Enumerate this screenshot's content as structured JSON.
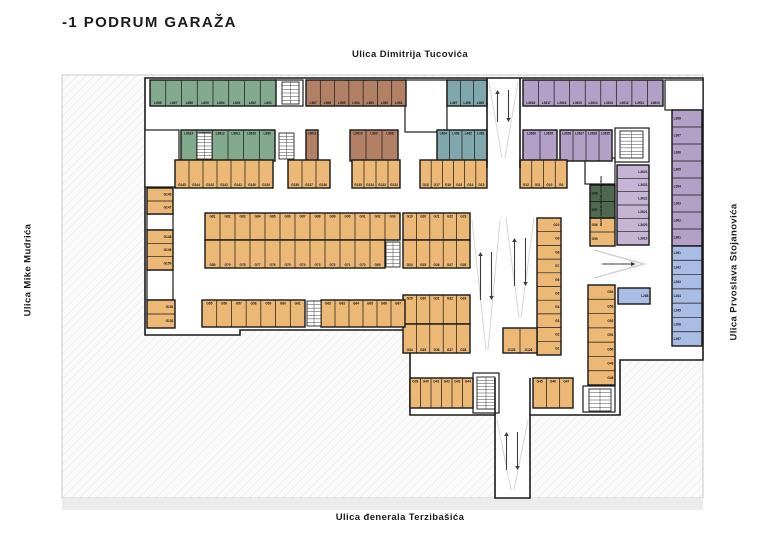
{
  "title": "-1 PODRUM GARAŽA",
  "streets": {
    "top": "Ulica Dimitrija Tucovića",
    "bottom": "Ulica đenerala Terzibašića",
    "left": "Ulica Mike Mudrića",
    "right": "Ulica Prvoslava Stojanovića"
  },
  "plan": {
    "colors": {
      "site": "#fbfbfb",
      "hatch": "#e3e3e3",
      "wall": "#1a1a1a",
      "street_band": "#ececec",
      "slope": "#d6d6d6",
      "arrow": "#3d3d3d",
      "chevron": "#cfcfcf",
      "label": "#141414",
      "green": "#83aa8c",
      "brown": "#b28165",
      "teal": "#7fa7ac",
      "purple": "#b3a0c6",
      "purple_light": "#c6b4d5",
      "blue": "#a9bce4",
      "orange": "#ecb875",
      "darkgreen": "#4e6950"
    },
    "site": {
      "x": 62,
      "y": 75,
      "w": 641,
      "h": 423
    },
    "street_band": {
      "x": 62,
      "y": 498,
      "w": 641,
      "h": 12
    },
    "outline": [
      [
        145,
        78
      ],
      [
        703,
        78
      ],
      [
        703,
        360
      ],
      [
        620,
        360
      ],
      [
        620,
        415
      ],
      [
        530,
        415
      ],
      [
        530,
        498
      ],
      [
        495,
        498
      ],
      [
        495,
        415
      ],
      [
        410,
        415
      ],
      [
        410,
        330
      ],
      [
        240,
        330
      ],
      [
        240,
        335
      ],
      [
        145,
        335
      ]
    ],
    "rooms": [
      [
        275,
        80,
        28,
        26
      ],
      [
        405,
        80,
        42,
        52
      ],
      [
        665,
        80,
        38,
        30
      ],
      [
        145,
        130,
        34,
        57
      ],
      [
        615,
        128,
        34,
        34
      ],
      [
        473,
        373,
        26,
        40
      ],
      [
        583,
        386,
        32,
        26
      ],
      [
        585,
        158,
        30,
        26
      ],
      [
        147,
        214,
        26,
        16
      ],
      [
        147,
        270,
        26,
        30
      ]
    ],
    "walls": [
      [
        487,
        78,
        487,
        168
      ],
      [
        520,
        78,
        520,
        168
      ],
      [
        495,
        378,
        495,
        415
      ],
      [
        530,
        378,
        530,
        415
      ]
    ],
    "slopes": [
      [
        489,
        82,
        502,
        158
      ],
      [
        518,
        82,
        505,
        158
      ],
      [
        472,
        220,
        486,
        350
      ],
      [
        500,
        220,
        488,
        350
      ],
      [
        506,
        218,
        519,
        318
      ],
      [
        534,
        218,
        521,
        318
      ],
      [
        497,
        420,
        511,
        490
      ],
      [
        528,
        420,
        514,
        490
      ]
    ],
    "arrows": [
      {
        "cx": 503,
        "y1": 90,
        "y2": 122
      },
      {
        "cx": 486,
        "y1": 252,
        "y2": 300
      },
      {
        "cx": 520,
        "y1": 238,
        "y2": 286
      },
      {
        "cx": 512,
        "y1": 432,
        "y2": 470
      }
    ],
    "chevron": {
      "x1": 594,
      "y1": 250,
      "xm": 644,
      "ym": 264,
      "x2": 594,
      "y2": 278,
      "ax1": 602,
      "ax2": 632
    },
    "stairs": [
      [
        282,
        82,
        17,
        22
      ],
      [
        197,
        133,
        15,
        26
      ],
      [
        279,
        133,
        15,
        26
      ],
      [
        386,
        242,
        14,
        25
      ],
      [
        307,
        301,
        14,
        25
      ],
      [
        477,
        377,
        18,
        32
      ],
      [
        620,
        131,
        23,
        27
      ],
      [
        589,
        389,
        22,
        22
      ]
    ],
    "ev_text": {
      "x": 602,
      "y": 201,
      "label": "MESTO ZA ELEKTRIČNE AUTOMOBILE"
    },
    "zones": [
      {
        "name": "green",
        "color": "green",
        "groups": [
          {
            "x": 150,
            "y": 80,
            "w": 126,
            "h": 26,
            "dir": "h",
            "pos": "bottom",
            "labels": [
              "L868",
              "L867",
              "L866",
              "L865",
              "L864",
              "L863",
              "L862",
              "L861"
            ]
          },
          {
            "x": 181,
            "y": 130,
            "w": 94,
            "h": 31,
            "dir": "h",
            "pos": "top",
            "labels": [
              "L8614",
              "L8613",
              "L8612",
              "L8611",
              "L8610",
              "L869"
            ]
          }
        ]
      },
      {
        "name": "brown",
        "color": "brown",
        "groups": [
          {
            "x": 306,
            "y": 80,
            "w": 100,
            "h": 26,
            "dir": "h",
            "pos": "bottom",
            "labels": [
              "L567",
              "L566",
              "L565",
              "L564",
              "L563",
              "L562",
              "L561"
            ]
          },
          {
            "x": 306,
            "y": 130,
            "w": 12,
            "h": 31,
            "dir": "h",
            "pos": "top",
            "labels": [
              "L5611"
            ]
          },
          {
            "x": 350,
            "y": 130,
            "w": 48,
            "h": 31,
            "dir": "h",
            "pos": "top",
            "labels": [
              "L5610",
              "L569",
              "L568"
            ]
          }
        ]
      },
      {
        "name": "teal",
        "color": "teal",
        "groups": [
          {
            "x": 447,
            "y": 80,
            "w": 40,
            "h": 26,
            "dir": "h",
            "pos": "bottom",
            "labels": [
              "L467",
              "L466",
              "L465"
            ]
          },
          {
            "x": 437,
            "y": 130,
            "w": 50,
            "h": 31,
            "dir": "h",
            "pos": "top",
            "labels": [
              "L464",
              "L463",
              "L462",
              "L461"
            ]
          }
        ]
      },
      {
        "name": "purple",
        "color": "purple",
        "groups": [
          {
            "x": 523,
            "y": 80,
            "w": 140,
            "h": 26,
            "dir": "h",
            "pos": "bottom",
            "labels": [
              "L3618",
              "L3617",
              "L3616",
              "L3615",
              "L3614",
              "L3613",
              "L3612",
              "L3611",
              "L3610"
            ]
          },
          {
            "x": 523,
            "y": 130,
            "w": 34,
            "h": 31,
            "dir": "h",
            "pos": "top",
            "labels": [
              "L3630",
              "L3629"
            ]
          },
          {
            "x": 560,
            "y": 130,
            "w": 52,
            "h": 31,
            "dir": "h",
            "pos": "top",
            "labels": [
              "L3628",
              "L3627",
              "L3626",
              "L3625"
            ]
          },
          {
            "x": 672,
            "y": 110,
            "w": 30,
            "h": 136,
            "dir": "v",
            "pos": "left",
            "labels": [
              "L368",
              "L367",
              "L366",
              "L365",
              "L364",
              "L363",
              "L362",
              "L361"
            ]
          },
          {
            "x": 617,
            "y": 165,
            "w": 32,
            "h": 80,
            "dir": "v",
            "pos": "right",
            "c": "purple_light",
            "labels": [
              "L3624",
              "L3623",
              "L3622",
              "L3621",
              "L3620",
              "L3619"
            ]
          }
        ]
      },
      {
        "name": "blue",
        "color": "blue",
        "groups": [
          {
            "x": 672,
            "y": 246,
            "w": 30,
            "h": 100,
            "dir": "v",
            "pos": "left",
            "labels": [
              "L261",
              "L262",
              "L263",
              "L264",
              "L265",
              "L266",
              "L267"
            ]
          },
          {
            "x": 618,
            "y": 288,
            "w": 32,
            "h": 16,
            "dir": "v",
            "pos": "right",
            "labels": [
              "L268"
            ]
          }
        ]
      },
      {
        "name": "orange",
        "color": "orange",
        "groups": [
          {
            "x": 175,
            "y": 160,
            "w": 98,
            "h": 28,
            "dir": "h",
            "pos": "bottom",
            "labels": [
              "G145",
              "G144",
              "G143",
              "G142",
              "G141",
              "G140",
              "G139"
            ]
          },
          {
            "x": 288,
            "y": 160,
            "w": 42,
            "h": 28,
            "dir": "h",
            "pos": "bottom",
            "labels": [
              "G138",
              "G137",
              "G136"
            ]
          },
          {
            "x": 352,
            "y": 160,
            "w": 48,
            "h": 28,
            "dir": "h",
            "pos": "bottom",
            "labels": [
              "G135",
              "G134",
              "G133",
              "G132"
            ]
          },
          {
            "x": 420,
            "y": 160,
            "w": 67,
            "h": 28,
            "dir": "h",
            "pos": "bottom",
            "labels": [
              "G18",
              "G17",
              "G16",
              "G15",
              "G14",
              "G13"
            ]
          },
          {
            "x": 520,
            "y": 160,
            "w": 47,
            "h": 28,
            "dir": "h",
            "pos": "bottom",
            "labels": [
              "G12",
              "G11",
              "G10",
              "G9"
            ]
          },
          {
            "x": 147,
            "y": 188,
            "w": 26,
            "h": 26,
            "dir": "v",
            "pos": "right",
            "labels": [
              "G146",
              "G147"
            ]
          },
          {
            "x": 147,
            "y": 230,
            "w": 26,
            "h": 40,
            "dir": "v",
            "pos": "right",
            "labels": [
              "G148",
              "G149",
              "G150"
            ]
          },
          {
            "x": 147,
            "y": 300,
            "w": 28,
            "h": 28,
            "dir": "v",
            "pos": "right",
            "labels": [
              "G151",
              "G152"
            ]
          },
          {
            "x": 205,
            "y": 213,
            "w": 195,
            "h": 27,
            "dir": "h",
            "pos": "top",
            "labels": [
              "G81",
              "G82",
              "G83",
              "G84",
              "G85",
              "G86",
              "G87",
              "G88",
              "G89",
              "G90",
              "G91",
              "G92",
              "G93"
            ]
          },
          {
            "x": 205,
            "y": 240,
            "w": 180,
            "h": 28,
            "dir": "h",
            "pos": "bottom",
            "labels": [
              "G80",
              "G79",
              "G78",
              "G77",
              "G76",
              "G75",
              "G74",
              "G73",
              "G72",
              "G71",
              "G70",
              "G69"
            ]
          },
          {
            "x": 403,
            "y": 213,
            "w": 67,
            "h": 27,
            "dir": "h",
            "pos": "top",
            "labels": [
              "G19",
              "G20",
              "G21",
              "G22",
              "G23"
            ]
          },
          {
            "x": 403,
            "y": 240,
            "w": 67,
            "h": 28,
            "dir": "h",
            "pos": "bottom",
            "labels": [
              "G24",
              "G25",
              "G26",
              "G27",
              "G28"
            ]
          },
          {
            "x": 403,
            "y": 295,
            "w": 67,
            "h": 29,
            "dir": "h",
            "pos": "top",
            "labels": [
              "G29",
              "G30",
              "G31",
              "G32",
              "G33"
            ]
          },
          {
            "x": 403,
            "y": 324,
            "w": 67,
            "h": 29,
            "dir": "h",
            "pos": "bottom",
            "labels": [
              "G34",
              "G35",
              "G36",
              "G37",
              "G38"
            ]
          },
          {
            "x": 537,
            "y": 218,
            "w": 24,
            "h": 137,
            "dir": "v",
            "pos": "right",
            "labels": [
              "G10",
              "G9",
              "G8",
              "G7",
              "G6",
              "G5",
              "G4",
              "G3",
              "G2",
              "G1"
            ]
          },
          {
            "x": 503,
            "y": 328,
            "w": 34,
            "h": 25,
            "dir": "h",
            "pos": "bottom",
            "labels": [
              "G125",
              "G126"
            ]
          },
          {
            "x": 202,
            "y": 300,
            "w": 103,
            "h": 27,
            "dir": "h",
            "pos": "top",
            "labels": [
              "G55",
              "G56",
              "G57",
              "G58",
              "G59",
              "G60",
              "G61"
            ]
          },
          {
            "x": 321,
            "y": 300,
            "w": 84,
            "h": 27,
            "dir": "h",
            "pos": "top",
            "labels": [
              "G62",
              "G63",
              "G64",
              "G65",
              "G66",
              "G67"
            ]
          },
          {
            "x": 410,
            "y": 378,
            "w": 63,
            "h": 30,
            "dir": "h",
            "pos": "top",
            "labels": [
              "G39",
              "G40",
              "G41",
              "G42",
              "G43",
              "G44"
            ]
          },
          {
            "x": 533,
            "y": 378,
            "w": 40,
            "h": 30,
            "dir": "h",
            "pos": "top",
            "labels": [
              "G45",
              "G46",
              "G47"
            ]
          },
          {
            "x": 588,
            "y": 285,
            "w": 27,
            "h": 100,
            "dir": "v",
            "pos": "right",
            "labels": [
              "G54",
              "G53",
              "G52",
              "G51",
              "G50",
              "G49",
              "G48"
            ]
          },
          {
            "x": 590,
            "y": 218,
            "w": 25,
            "h": 28,
            "dir": "v",
            "pos": "left",
            "labels": [
              "G56",
              "G55"
            ]
          }
        ]
      },
      {
        "name": "ev",
        "color": "darkgreen",
        "groups": [
          {
            "x": 590,
            "y": 185,
            "w": 25,
            "h": 33,
            "dir": "v",
            "pos": "left",
            "labels": [
              "G58",
              "G57"
            ]
          }
        ]
      }
    ]
  }
}
